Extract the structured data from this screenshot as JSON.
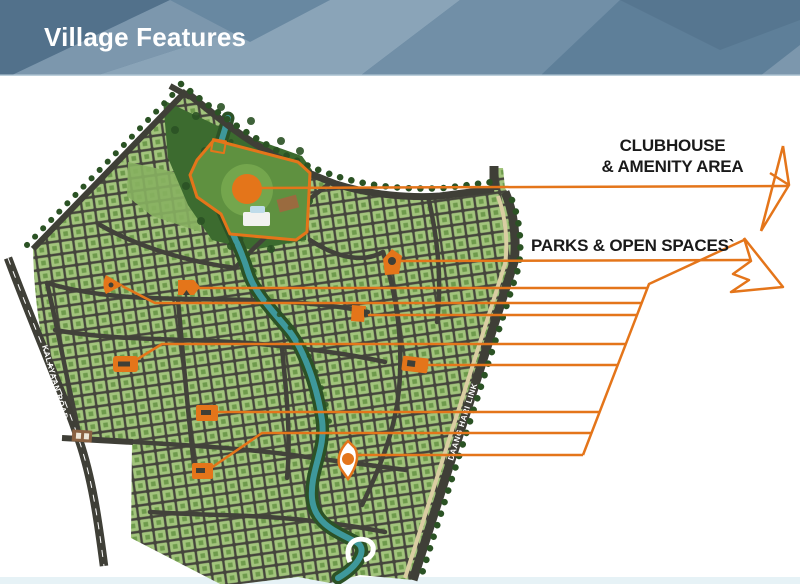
{
  "header": {
    "title": "Village Features"
  },
  "annotations": {
    "clubhouse_line1": "CLUBHOUSE",
    "clubhouse_line2": "& AMENITY AREA",
    "parks": "PARKS & OPEN SPACES`"
  },
  "map": {
    "road_labels": {
      "kalayaan": "KALAYAAN ROAD",
      "daang_hari": "DAANG HARI LINK"
    },
    "park_marker_count": 9,
    "clubhouse_marker_count": 1
  },
  "colors": {
    "header_blue": "#5E7F99",
    "accent_orange": "#E4751A",
    "lot_green": "#A2C47C",
    "lot_detail_green": "#6E9A4C",
    "road_dark": "#45453C",
    "park_green": "#3C6B2F",
    "tree_green": "#2B5224",
    "creek_teal": "#3E989B",
    "sidewalk_tan": "#D9CDA2",
    "label_black": "#1A1A1A",
    "bottom_strip": "#E6F2F6",
    "title_white": "#FFFFFF"
  }
}
